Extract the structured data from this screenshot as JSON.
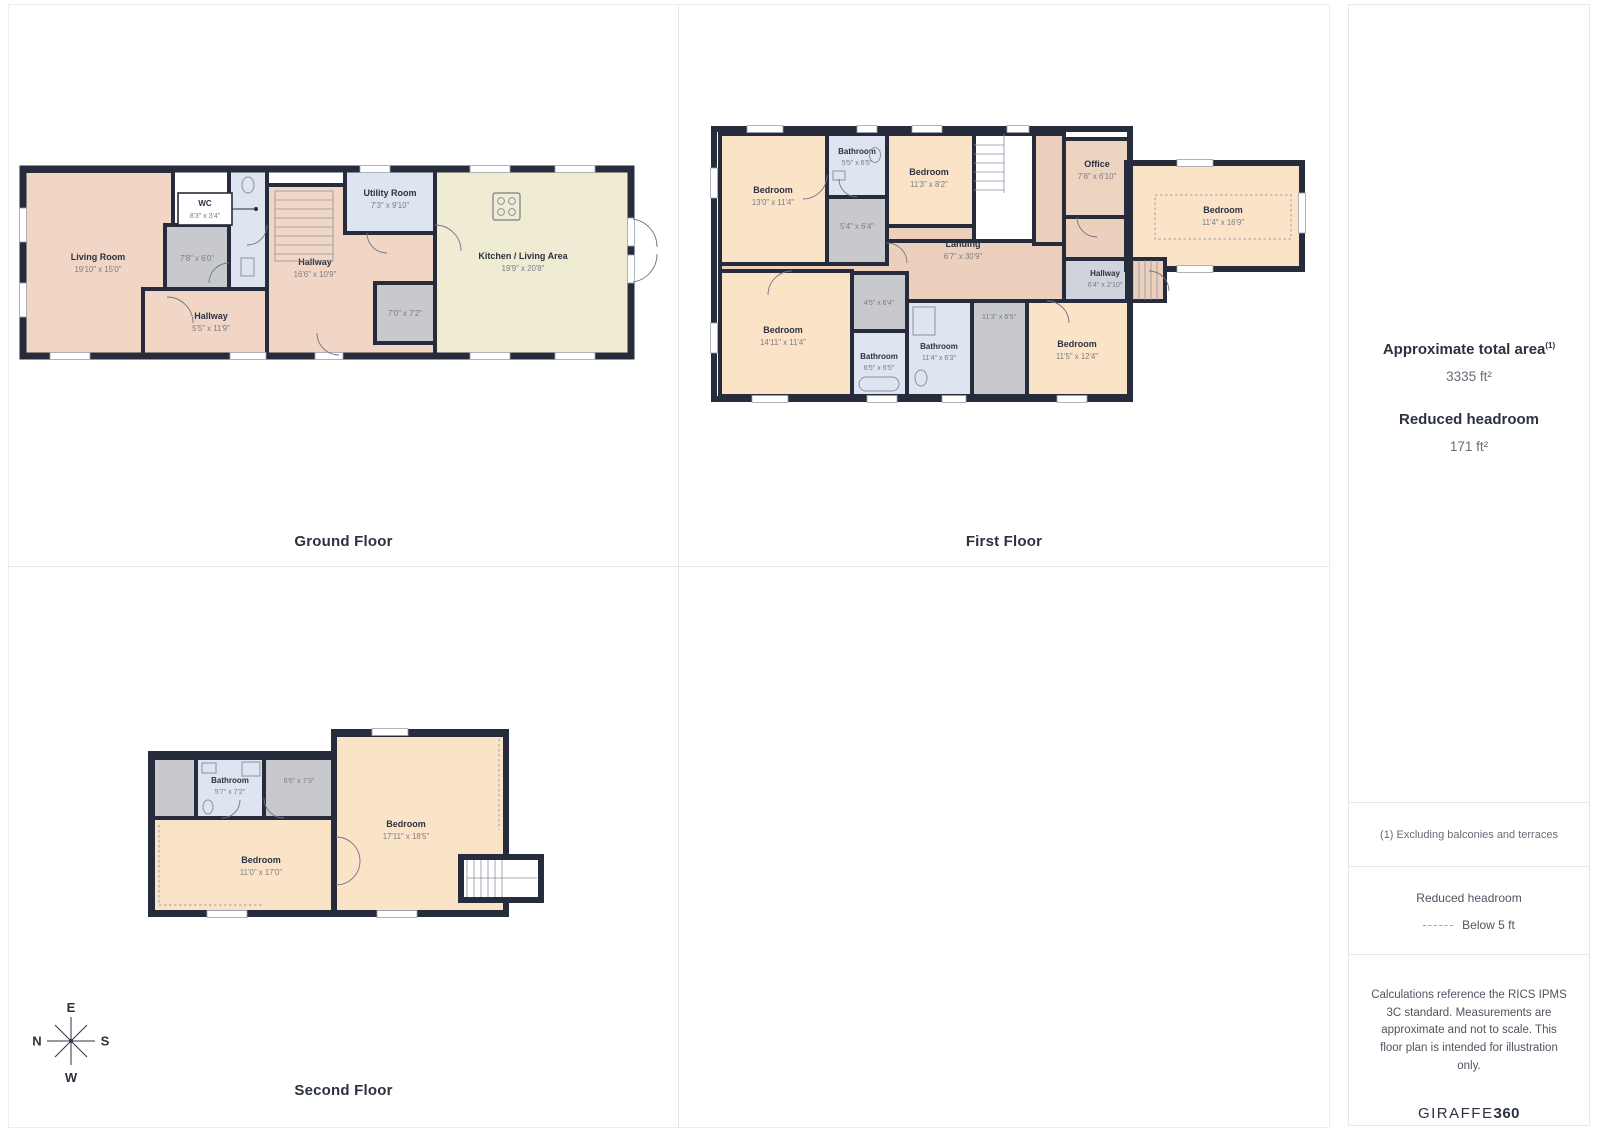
{
  "palette": {
    "wall": "#262c3c",
    "room_salmon": "#f2d6c5",
    "room_landing": "#ecd0bd",
    "room_peach": "#fbe3c8",
    "room_cream": "#f0ebd3",
    "room_blue": "#dfe5f0",
    "room_gray": "#c8c9cc",
    "room_hall_gray": "#cfd4dc",
    "text_dark": "#2b3240",
    "text_gray": "#787d85"
  },
  "floors": {
    "ground": {
      "label": "Ground Floor",
      "rooms": {
        "living": {
          "name": "Living Room",
          "dims": "19'10\" x 15'0\""
        },
        "wc": {
          "name": "WC",
          "dims": "8'3\" x 3'4\""
        },
        "store1": {
          "dims": "7'8\" x 6'0\""
        },
        "hall_main": {
          "name": "Hallway",
          "dims": "16'6\" x 10'9\""
        },
        "hall_south": {
          "name": "Hallway",
          "dims": "5'5\" x 11'9\""
        },
        "utility": {
          "name": "Utility Room",
          "dims": "7'3\" x 9'10\""
        },
        "store2": {
          "dims": "7'0\" x 7'2\""
        },
        "kitchen": {
          "name": "Kitchen / Living Area",
          "dims": "19'9\" x 20'8\""
        }
      }
    },
    "first": {
      "label": "First Floor",
      "rooms": {
        "bedroom_nw": {
          "name": "Bedroom",
          "dims": "13'0\" x 11'4\""
        },
        "bathroom_n": {
          "name": "Bathroom",
          "dims": "5'5\" x 6'5\""
        },
        "store_n": {
          "dims": "5'4\" x 6'4\""
        },
        "bedroom_n": {
          "name": "Bedroom",
          "dims": "11'3\" x 8'2\""
        },
        "landing": {
          "name": "Landing",
          "dims": "6'7\" x 30'9\""
        },
        "office": {
          "name": "Office",
          "dims": "7'8\" x 6'10\""
        },
        "bedroom_e": {
          "name": "Bedroom",
          "dims": "11'4\" x 16'9\""
        },
        "hallway": {
          "name": "Hallway",
          "dims": "6'4\" x 2'10\""
        },
        "bedroom_sw": {
          "name": "Bedroom",
          "dims": "14'11\" x 11'4\""
        },
        "store_s": {
          "dims": "4'5\" x 6'4\""
        },
        "bathroom_sw": {
          "name": "Bathroom",
          "dims": "6'5\" x 6'5\""
        },
        "bathroom_s": {
          "name": "Bathroom",
          "dims": "11'4\" x 6'3\""
        },
        "store_se": {
          "dims": "11'3\" x 6'5\""
        },
        "bedroom_se": {
          "name": "Bedroom",
          "dims": "11'5\" x 12'4\""
        }
      }
    },
    "second": {
      "label": "Second Floor",
      "rooms": {
        "bathroom": {
          "name": "Bathroom",
          "dims": "5'7\" x 7'2\""
        },
        "store": {
          "dims": "6'6\" x 7'3\""
        },
        "bedroom_e": {
          "name": "Bedroom",
          "dims": "17'11\" x 18'5\""
        },
        "bedroom_w": {
          "name": "Bedroom",
          "dims": "11'0\" x 17'0\""
        }
      }
    }
  },
  "sidebar": {
    "area_title": "Approximate total area",
    "area_ref": "(1)",
    "area_value": "3335 ft²",
    "headroom_title": "Reduced headroom",
    "headroom_value": "171 ft²",
    "footnote": "(1) Excluding balconies and terraces",
    "legend_title": "Reduced headroom",
    "legend_item": "Below 5 ft",
    "disclaimer": "Calculations reference the RICS IPMS 3C standard. Measurements are approximate and not to scale. This floor plan is intended for illustration only.",
    "brand_name": "GIRAFFE",
    "brand_suffix": "360"
  },
  "compass": {
    "top": "E",
    "left": "N",
    "right": "S",
    "bottom": "W"
  }
}
